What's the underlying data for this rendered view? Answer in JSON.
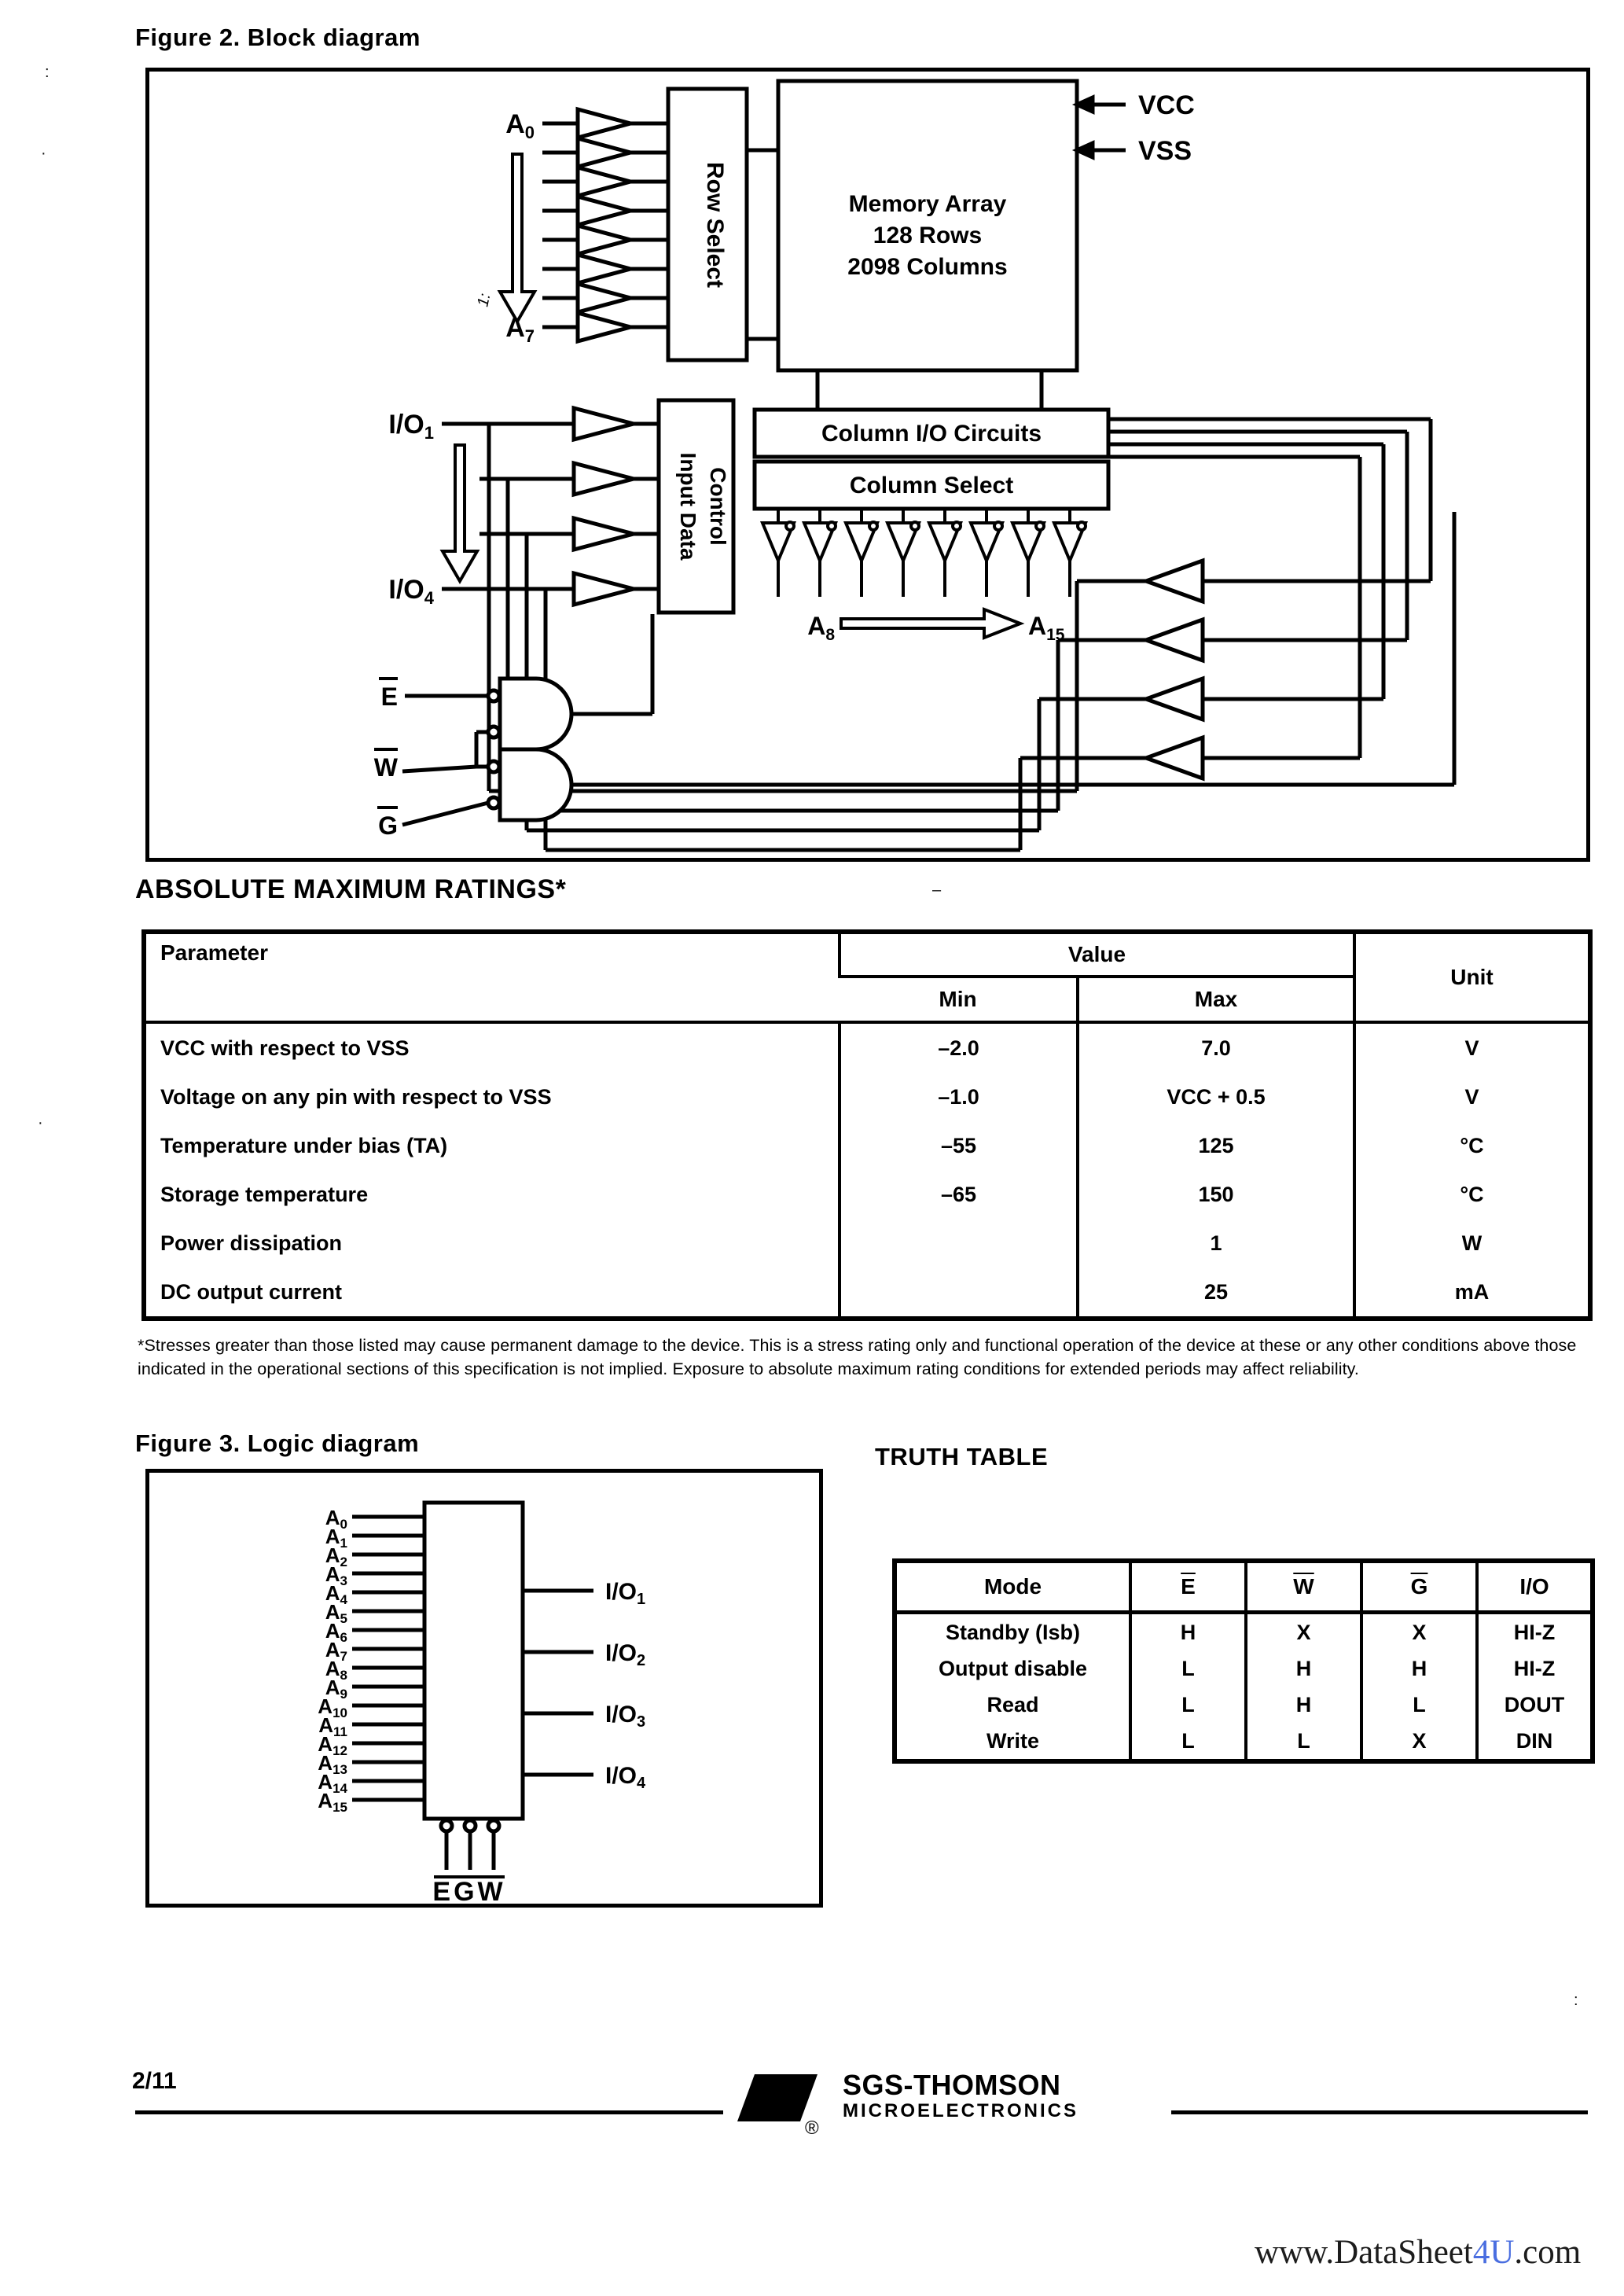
{
  "figure2": {
    "title": "Figure 2. Block diagram",
    "row_select": "Row Select",
    "memory_array": [
      "Memory Array",
      "128 Rows",
      "2098 Columns"
    ],
    "vcc": "VCC",
    "vss": "VSS",
    "a0_base": "A",
    "a0_sub": "0",
    "a7_base": "A",
    "a7_sub": "7",
    "io1_base": "I/O",
    "io1_sub": "1",
    "io4_base": "I/O",
    "io4_sub": "4",
    "idc_line1": "Input Data",
    "idc_line2": "Control",
    "column_io": "Column I/O Circuits",
    "column_select": "Column Select",
    "a8_base": "A",
    "a8_sub": "8",
    "a15_base": "A",
    "a15_sub": "15",
    "e": "E",
    "w": "W",
    "g": "G",
    "mark": "1:"
  },
  "ratings": {
    "heading": "ABSOLUTE MAXIMUM RATINGS*",
    "col_parameter": "Parameter",
    "col_value": "Value",
    "col_min": "Min",
    "col_max": "Max",
    "col_unit": "Unit",
    "rows": [
      {
        "parameter": "VCC with respect to VSS",
        "min": "–2.0",
        "max": "7.0",
        "unit": "V"
      },
      {
        "parameter": "Voltage on any pin with respect to VSS",
        "min": "–1.0",
        "max": "VCC + 0.5",
        "unit": "V"
      },
      {
        "parameter": "Temperature under bias (TA)",
        "min": "–55",
        "max": "125",
        "unit": "°C"
      },
      {
        "parameter": "Storage temperature",
        "min": "–65",
        "max": "150",
        "unit": "°C"
      },
      {
        "parameter": "Power dissipation",
        "min": "",
        "max": "1",
        "unit": "W"
      },
      {
        "parameter": "DC output current",
        "min": "",
        "max": "25",
        "unit": "mA"
      }
    ],
    "footnote": "*Stresses greater than those listed may cause permanent damage to the device. This is a stress rating only and functional operation of the device at these or any other conditions above those indicated in the operational sections of this specification is not implied. Exposure to absolute maximum rating conditions for extended periods may affect reliability."
  },
  "figure3": {
    "title": "Figure 3. Logic diagram",
    "addresses": [
      {
        "base": "A",
        "sub": "0"
      },
      {
        "base": "A",
        "sub": "1"
      },
      {
        "base": "A",
        "sub": "2"
      },
      {
        "base": "A",
        "sub": "3"
      },
      {
        "base": "A",
        "sub": "4"
      },
      {
        "base": "A",
        "sub": "5"
      },
      {
        "base": "A",
        "sub": "6"
      },
      {
        "base": "A",
        "sub": "7"
      },
      {
        "base": "A",
        "sub": "8"
      },
      {
        "base": "A",
        "sub": "9"
      },
      {
        "base": "A",
        "sub": "10"
      },
      {
        "base": "A",
        "sub": "11"
      },
      {
        "base": "A",
        "sub": "12"
      },
      {
        "base": "A",
        "sub": "13"
      },
      {
        "base": "A",
        "sub": "14"
      },
      {
        "base": "A",
        "sub": "15"
      }
    ],
    "ios": [
      {
        "base": "I/O",
        "sub": "1"
      },
      {
        "base": "I/O",
        "sub": "2"
      },
      {
        "base": "I/O",
        "sub": "3"
      },
      {
        "base": "I/O",
        "sub": "4"
      }
    ],
    "controls": "EGW"
  },
  "truth_table": {
    "heading": "TRUTH TABLE",
    "columns": [
      "Mode",
      "E",
      "W",
      "G",
      "I/O"
    ],
    "rows": [
      {
        "mode": "Standby (Isb)",
        "e": "H",
        "w": "X",
        "g": "X",
        "io": "HI-Z"
      },
      {
        "mode": "Output disable",
        "e": "L",
        "w": "H",
        "g": "H",
        "io": "HI-Z"
      },
      {
        "mode": "Read",
        "e": "L",
        "w": "H",
        "g": "L",
        "io": "DOUT"
      },
      {
        "mode": "Write",
        "e": "L",
        "w": "L",
        "g": "X",
        "io": "DIN"
      }
    ]
  },
  "footer": {
    "page_number": "2/11",
    "logo_monogram": "ST",
    "brand": "SGS-THOMSON",
    "brand_sub": "MICROELECTRONICS",
    "reg": "®"
  },
  "watermark": {
    "prefix": "www.DataSheet",
    "highlight": "4U",
    "suffix": ".com",
    "highlight_color": "#4a6ee0"
  },
  "artifacts": {
    "a1": ":",
    "a2": "·",
    "a3": "·",
    "a4": "–",
    "a5": "·",
    "a6": ":"
  }
}
